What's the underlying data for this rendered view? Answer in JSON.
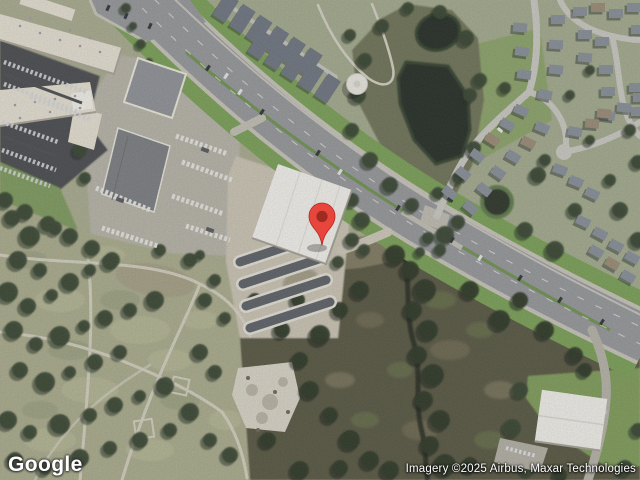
{
  "map": {
    "view_type": "satellite",
    "logo_text": "Google",
    "attribution": "Imagery ©2025 Airbus, Maxar Technologies",
    "marker": {
      "fill": "#E8453C",
      "outline": "#B4281E",
      "dot_fill": "#9C2B20"
    },
    "colors": {
      "road_asphalt": "#95979A",
      "road_concrete": "#C7C4B9",
      "grass_verge": "#79A055",
      "pond_water": "#242C22",
      "park_ground": "#A9AB8E",
      "scrubland": "#56543F",
      "building_white_roof": "#F4F3EE",
      "mall_roof": "#E7E1D3",
      "parking_lot": "#46484D"
    }
  }
}
